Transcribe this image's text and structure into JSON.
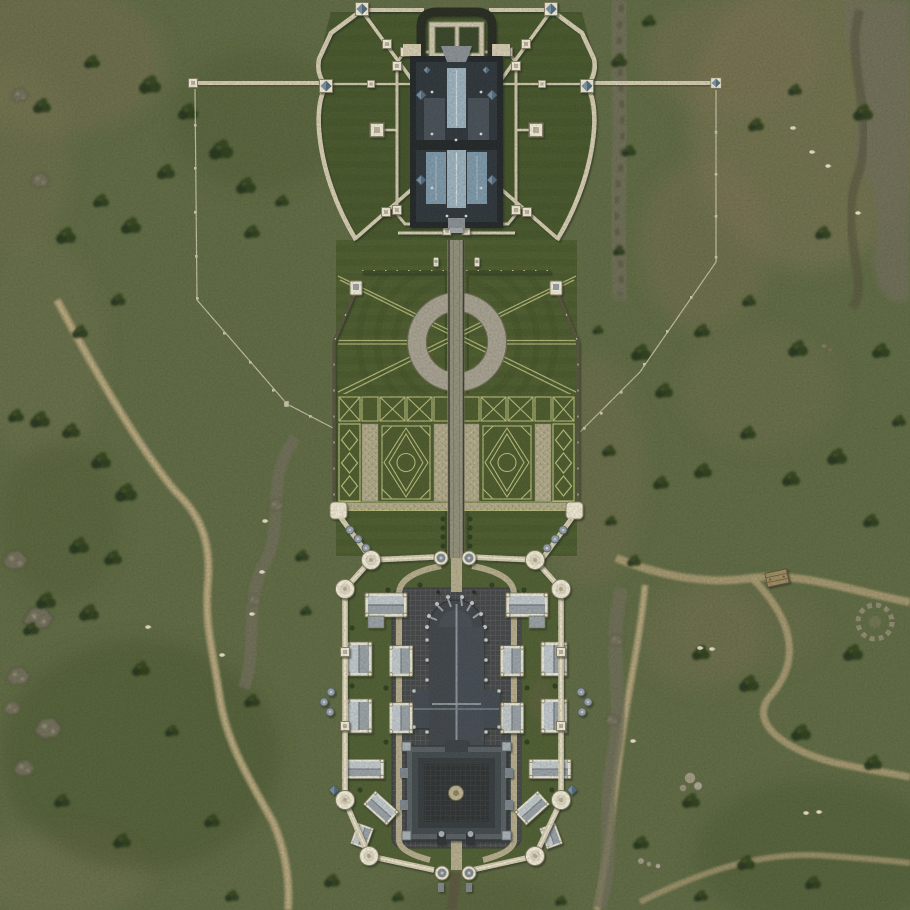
{
  "meta": {
    "view": "top-down overhead map",
    "scene": "walled estate with north fortress, ornamental gardens and south palace compound set in meadowland",
    "visible_text": "none"
  },
  "colors": {
    "grass": "#5f6a45",
    "grassDark": "#46522e",
    "grassDry": "#80795a",
    "scrub": "#7d7456",
    "tree": "#2c3a1e",
    "rock": "#716e5b",
    "rockLight": "#989378",
    "rockDark": "#52503e",
    "dirt": "#ab9b75",
    "dirtLight": "#c2b28a",
    "lawn": "#4d5c30",
    "lawnDark": "#43522a",
    "bed": "#4c5a2e",
    "hedgeLine": "#b9bd7e",
    "hedgeDark": "#3c4a26",
    "gravel": "#b2aa8c",
    "gravelDot": "#948c70",
    "ring": "#a8a294",
    "roadFill": "#94917f",
    "roadEdge": "#3e3e34",
    "wall": "#d6cdb4",
    "wallLight": "#efe8d4",
    "wallShadow": "#4a4536",
    "tower": "#f2ecda",
    "pyr": "#7792a5",
    "pyrDark": "#4c6375",
    "keepDark": "#23272c",
    "keepBody": "#2e353c",
    "keepPanel": "#46505a",
    "keepBlue": "#7e99ad",
    "keepGable": "#9db3c2",
    "gableRidge": "#cfdae2",
    "slate": "#3f454d",
    "slateHi": "#8a939e",
    "pinnacle": "#c9ccd1",
    "roofLight": "#c3cad0",
    "roofMid": "#9aa2aa",
    "bldgWall": "#e9e7da",
    "plaza": "#45464a",
    "plazaLine": "#55575b",
    "court": "#2e3134",
    "courtLine": "#3b3e42",
    "pathTan": "#b7ad8f",
    "fence": "#cdc8b2",
    "sheep": "#e9e2cc",
    "shedWood": "#a08c63"
  },
  "regions": {
    "map": {
      "label": "Overhead map of a fortified estate"
    },
    "meadow": {
      "label": "Open meadows and dry grass"
    },
    "rocks": {
      "label": "Rocky outcrops and cliff bands"
    },
    "trails": {
      "label": "Winding dirt trails"
    },
    "trees": {
      "label": "Tree and shrub clusters"
    },
    "wildlife": {
      "label": "Grazing sheep and deer"
    },
    "shed": {
      "label": "Wooden cart shed"
    },
    "stoneCircle": {
      "label": "Ruined stone circle"
    },
    "fences": {
      "label": "Paddock fences with posts"
    },
    "wallArms": {
      "label": "Curtain wall arms with end turrets"
    },
    "fortress": {
      "label": "North fortress with bastioned wall"
    },
    "keep": {
      "label": "Central keep with blue slate roofs"
    },
    "northForecourt": {
      "label": "North entrance forecourt with twin gates"
    },
    "statues": {
      "label": "Twin statues flanking the avenue"
    },
    "circularGarden": {
      "label": "Circular ring garden with diagonal walks"
    },
    "parterre": {
      "label": "Formal parterre garden with knot beds"
    },
    "road": {
      "label": "Central estate avenue"
    },
    "palace": {
      "label": "South palace compound inside octagonal wall"
    },
    "cathedral": {
      "label": "Great hall with rounded apse and pinnacles"
    },
    "court": {
      "label": "Inner courtyard palace with round basin"
    },
    "houses": {
      "label": "Courtier houses along the walls"
    },
    "southGate": {
      "label": "South twin-tower gatehouse"
    },
    "northPalaceGate": {
      "label": "North twin-tower gatehouse of the palace compound"
    }
  }
}
